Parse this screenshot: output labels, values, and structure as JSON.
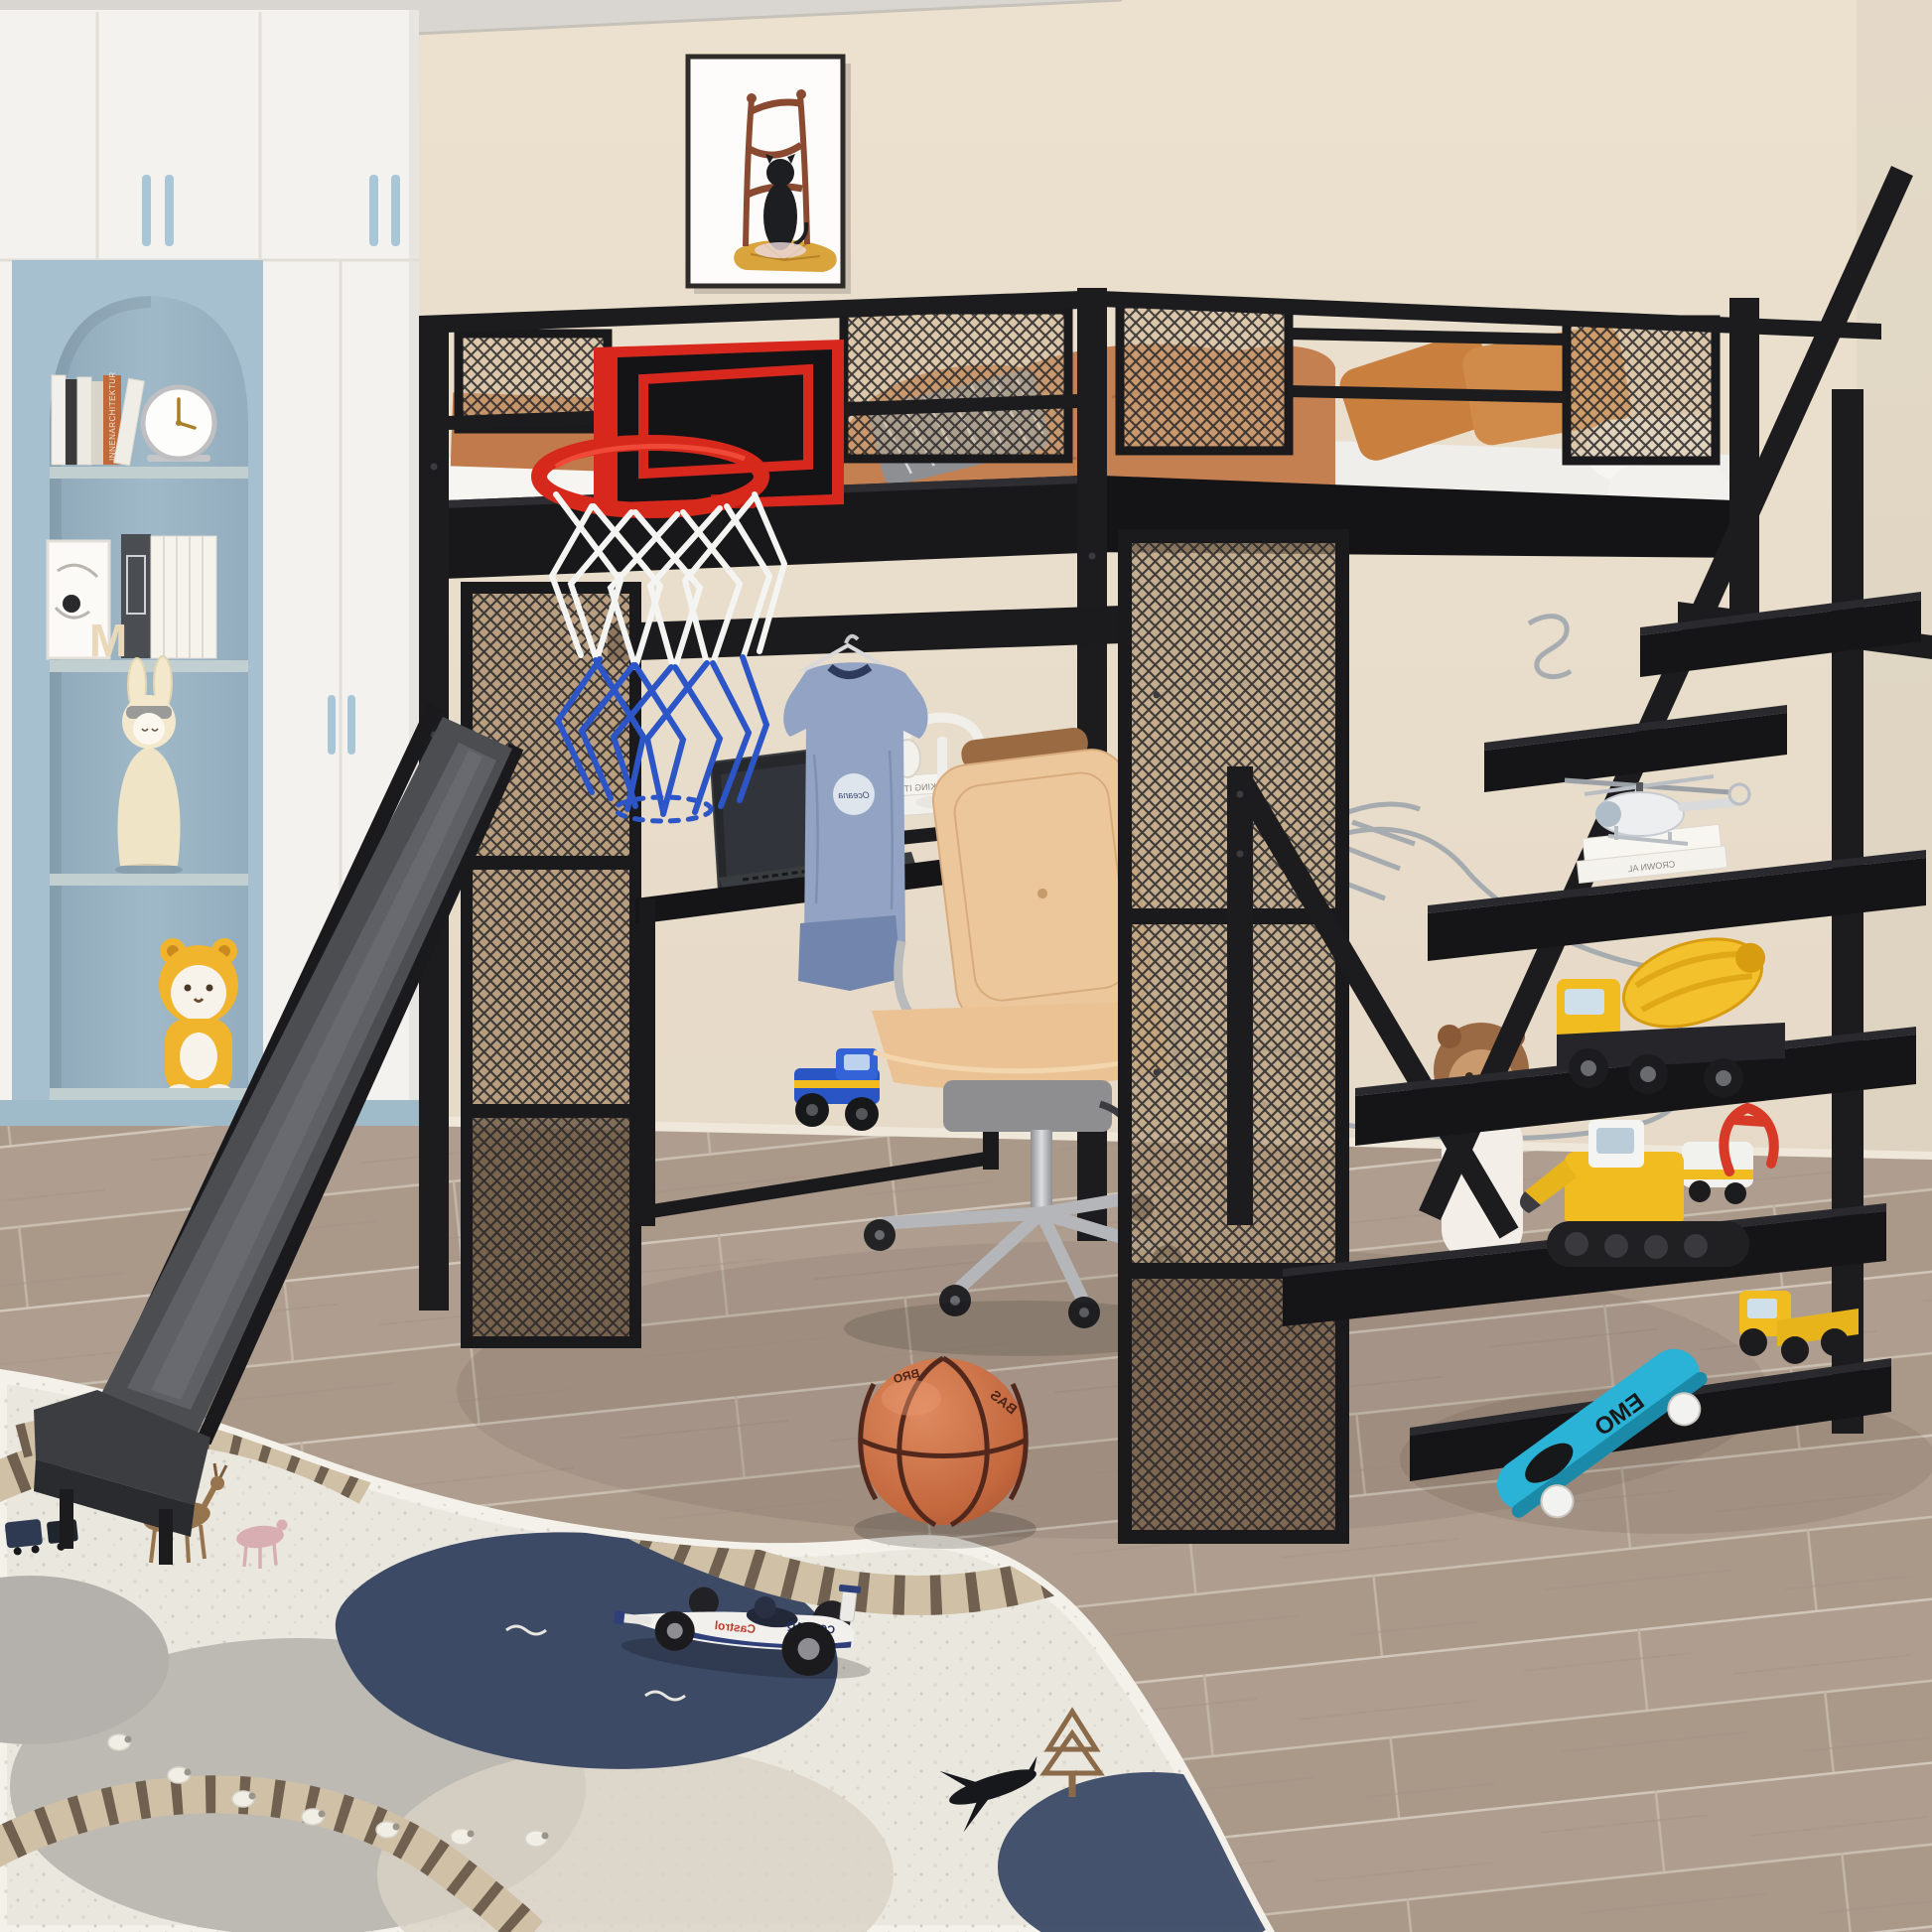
{
  "scene": {
    "title": "Kids bedroom with black metal loft bed, basketball hoop, slide, desk and staircase shelves",
    "room": "children's bedroom product render"
  },
  "palette": {
    "wall_beige": "#e7dccb",
    "cabinet_white": "#f4f2ee",
    "niche_blue": "#a6c0d0",
    "frame_black": "#1c1c1f",
    "mesh_tan": "#c3a988",
    "accent_red": "#d8281e",
    "net_blue": "#2c55c8",
    "bedding_orange": "#c58052",
    "chair_tan": "#ecc79c",
    "floor_wood": "#b5a395",
    "rug_cream": "#eae7df",
    "rug_navy": "#3c4a66",
    "slide_grey": "#4c4d51",
    "toy_yellow": "#f0bc20",
    "skateboard_teal": "#2ab3d6",
    "basketball_orange": "#c96f45"
  },
  "visible_text": {
    "book_spine_innenarchitektur": "INNENARCHITEKTUR",
    "letter_m": "M",
    "shirt_logo": "Oceana",
    "desk_book_spine": "MAKING IT",
    "shelf_book_spine": "CROWN AL",
    "race_car_sponsor_castrol": "Castrol",
    "race_car_sponsor_compaq": "COMPAQ",
    "basketball_text_1": "BAS",
    "basketball_text_2": "BRO",
    "skateboard_text": "EMO"
  },
  "objects": {
    "wardrobe": "white built-in cabinets with blue handles and arched blue display niche",
    "niche_items": [
      "books",
      "desk clock",
      "art print",
      "letter M",
      "bunny figurine",
      "yellow bear plush"
    ],
    "wall_art": "framed print of black cat on wooden chair",
    "loft_bed": "black metal loft bed with mesh guard panels",
    "backboard": "black basketball backboard with red trim, red rim, white and blue net",
    "slide": "dark grey metal slide to floor",
    "desk_items": [
      "laptop",
      "white books",
      "headphones on stand",
      "blue t-shirt on hanger",
      "blue toy truck"
    ],
    "chair": "tan leather swivel office chair",
    "staircase_shelves_toys": [
      "toy helicopter on books",
      "cement mixer truck",
      "excavator",
      "red claw toy",
      "dump truck with trailer",
      "teal skateboard",
      "lion plush"
    ],
    "floor_items": [
      "basketball",
      "play rug with train tracks",
      "white formula race car toy"
    ]
  }
}
